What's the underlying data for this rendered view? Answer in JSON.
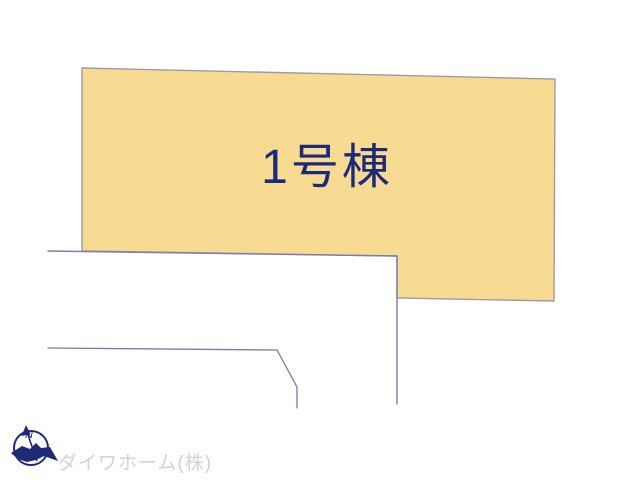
{
  "diagram": {
    "background_color": "#ffffff",
    "lot": {
      "label": "1号棟",
      "fill": "#f8db93",
      "stroke": "#a09aa4",
      "label_color": "#1c2a77",
      "label_x": "327",
      "label_y": "183",
      "points": "82,68 555,79 554,301 397,298 397,256 82,251"
    },
    "boundaries": {
      "stroke": "#7b7bac",
      "upper_parcel_points": "48,251 397,256 397,404",
      "lower_parcel_points": "48,348 277,350 297,387 297,408"
    }
  },
  "compass": {
    "north_label": "N",
    "color": "#1c2a77"
  },
  "footer": {
    "company_name": "ダイワホーム(株)",
    "color": "#d2d2d7"
  }
}
